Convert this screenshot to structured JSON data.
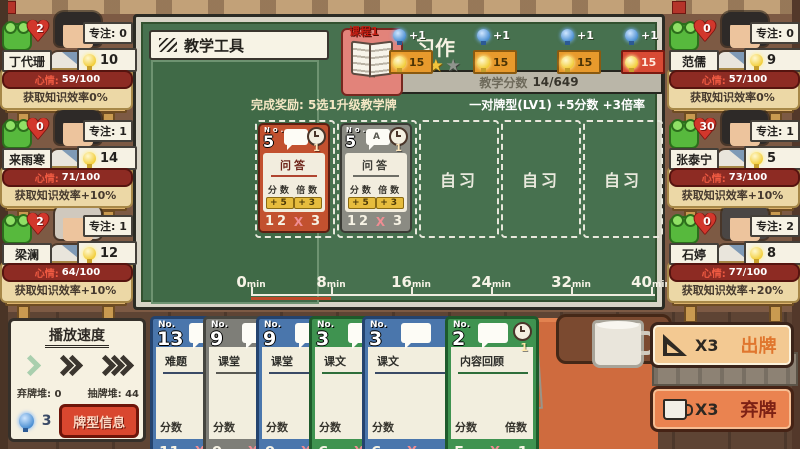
{
  "students_left": [
    {
      "name": "丁代珊",
      "heart": "2",
      "focus": "专注: 0",
      "bulb": "10",
      "mood_label": "心情:",
      "mood_value": "59/100",
      "efficiency": "获取知识效率0%",
      "hair": "#2e2a28"
    },
    {
      "name": "来雨寒",
      "heart": "0",
      "focus": "专注: 1",
      "bulb": "14",
      "mood_label": "心情:",
      "mood_value": "71/100",
      "efficiency": "获取知识效率+10%",
      "hair": "#2e2a28"
    },
    {
      "name": "梁澜",
      "heart": "2",
      "focus": "专注: 1",
      "bulb": "12",
      "mood_label": "心情:",
      "mood_value": "64/100",
      "efficiency": "获取知识效率+10%",
      "hair": "#d0c9be"
    }
  ],
  "students_right": [
    {
      "name": "范儒",
      "heart": "0",
      "focus": "专注: 0",
      "bulb": "9",
      "mood_label": "心情:",
      "mood_value": "57/100",
      "efficiency": "获取知识效率0%",
      "hair": "#2e2a28"
    },
    {
      "name": "张泰宁",
      "heart": "30",
      "focus": "专注: 1",
      "bulb": "5",
      "mood_label": "心情:",
      "mood_value": "73/100",
      "efficiency": "获取知识效率+10%",
      "hair": "#2e2a28"
    },
    {
      "name": "石婷",
      "heart": "0",
      "focus": "专注: 2",
      "bulb": "8",
      "mood_label": "心情:",
      "mood_value": "77/100",
      "efficiency": "获取知识效率+20%",
      "hair": "#4a4644"
    }
  ],
  "board": {
    "tools_title": "教学工具",
    "lesson_badge": "课程1",
    "lesson_title": "习作",
    "stars_filled": 2,
    "stars_total": 3,
    "star_glyph": "★",
    "progress_label": "教学分数",
    "progress_value": "14/649",
    "milestones": [
      {
        "gain": "+1",
        "value": "15"
      },
      {
        "gain": "+1",
        "value": "15"
      },
      {
        "gain": "+1",
        "value": "15"
      },
      {
        "gain": "+1",
        "value": "15"
      }
    ],
    "reward_text": "完成奖励: 5选1升级教学牌",
    "combo_text": "一对牌型(LV1) +5分数 +3倍率",
    "cards": [
      {
        "no_label": "No.",
        "no": "5",
        "bubble_text": "",
        "duration": "1",
        "title": "问答",
        "score_label": "分数",
        "score_bonus": "+5",
        "mult_label": "倍数",
        "mult_bonus": "+3",
        "score": "12",
        "times": "X",
        "mult": "3",
        "color": "orange"
      },
      {
        "no_label": "No.",
        "no": "5",
        "bubble_text": "A",
        "duration": "1",
        "title": "问答",
        "score_label": "分数",
        "score_bonus": "+5",
        "mult_label": "倍数",
        "mult_bonus": "+3",
        "score": "12",
        "times": "X",
        "mult": "3",
        "color": "gray"
      }
    ],
    "empty_slot_label": "自习",
    "timeline": [
      "0",
      "8",
      "16",
      "24",
      "32",
      "40"
    ],
    "timeline_unit": "min"
  },
  "playback": {
    "title": "播放速度",
    "discard_pile_label": "弃牌堆: 0",
    "draw_pile_label": "抽牌堆: 44",
    "bulb_count": "3",
    "info_button_label": "牌型信息"
  },
  "hand": [
    {
      "no_label": "No.",
      "no": "13",
      "title": "难题",
      "score_label": "分数",
      "score": "11",
      "times": "X",
      "color": "blue"
    },
    {
      "no_label": "No.",
      "no": "9",
      "title": "课堂",
      "score_label": "分数",
      "score": "9",
      "times": "X",
      "color": "gray"
    },
    {
      "no_label": "No.",
      "no": "9",
      "title": "课堂",
      "score_label": "分数",
      "score": "9",
      "times": "X",
      "color": "blue"
    },
    {
      "no_label": "No.",
      "no": "3",
      "title": "课文",
      "score_label": "分数",
      "score": "6",
      "times": "X",
      "color": "green"
    },
    {
      "no_label": "No.",
      "no": "3",
      "title": "课文",
      "score_label": "分数",
      "score": "6",
      "times": "X",
      "color": "blue"
    },
    {
      "no_label": "No.",
      "no": "2",
      "title": "内容回顾",
      "duration": "1",
      "score_label": "分数",
      "mult_label": "倍数",
      "score": "5",
      "times": "X",
      "mult": "1",
      "color": "green"
    }
  ],
  "actions": {
    "play_count": "X3",
    "play_label": "出牌",
    "discard_count": "X3",
    "discard_label": "弃牌"
  }
}
